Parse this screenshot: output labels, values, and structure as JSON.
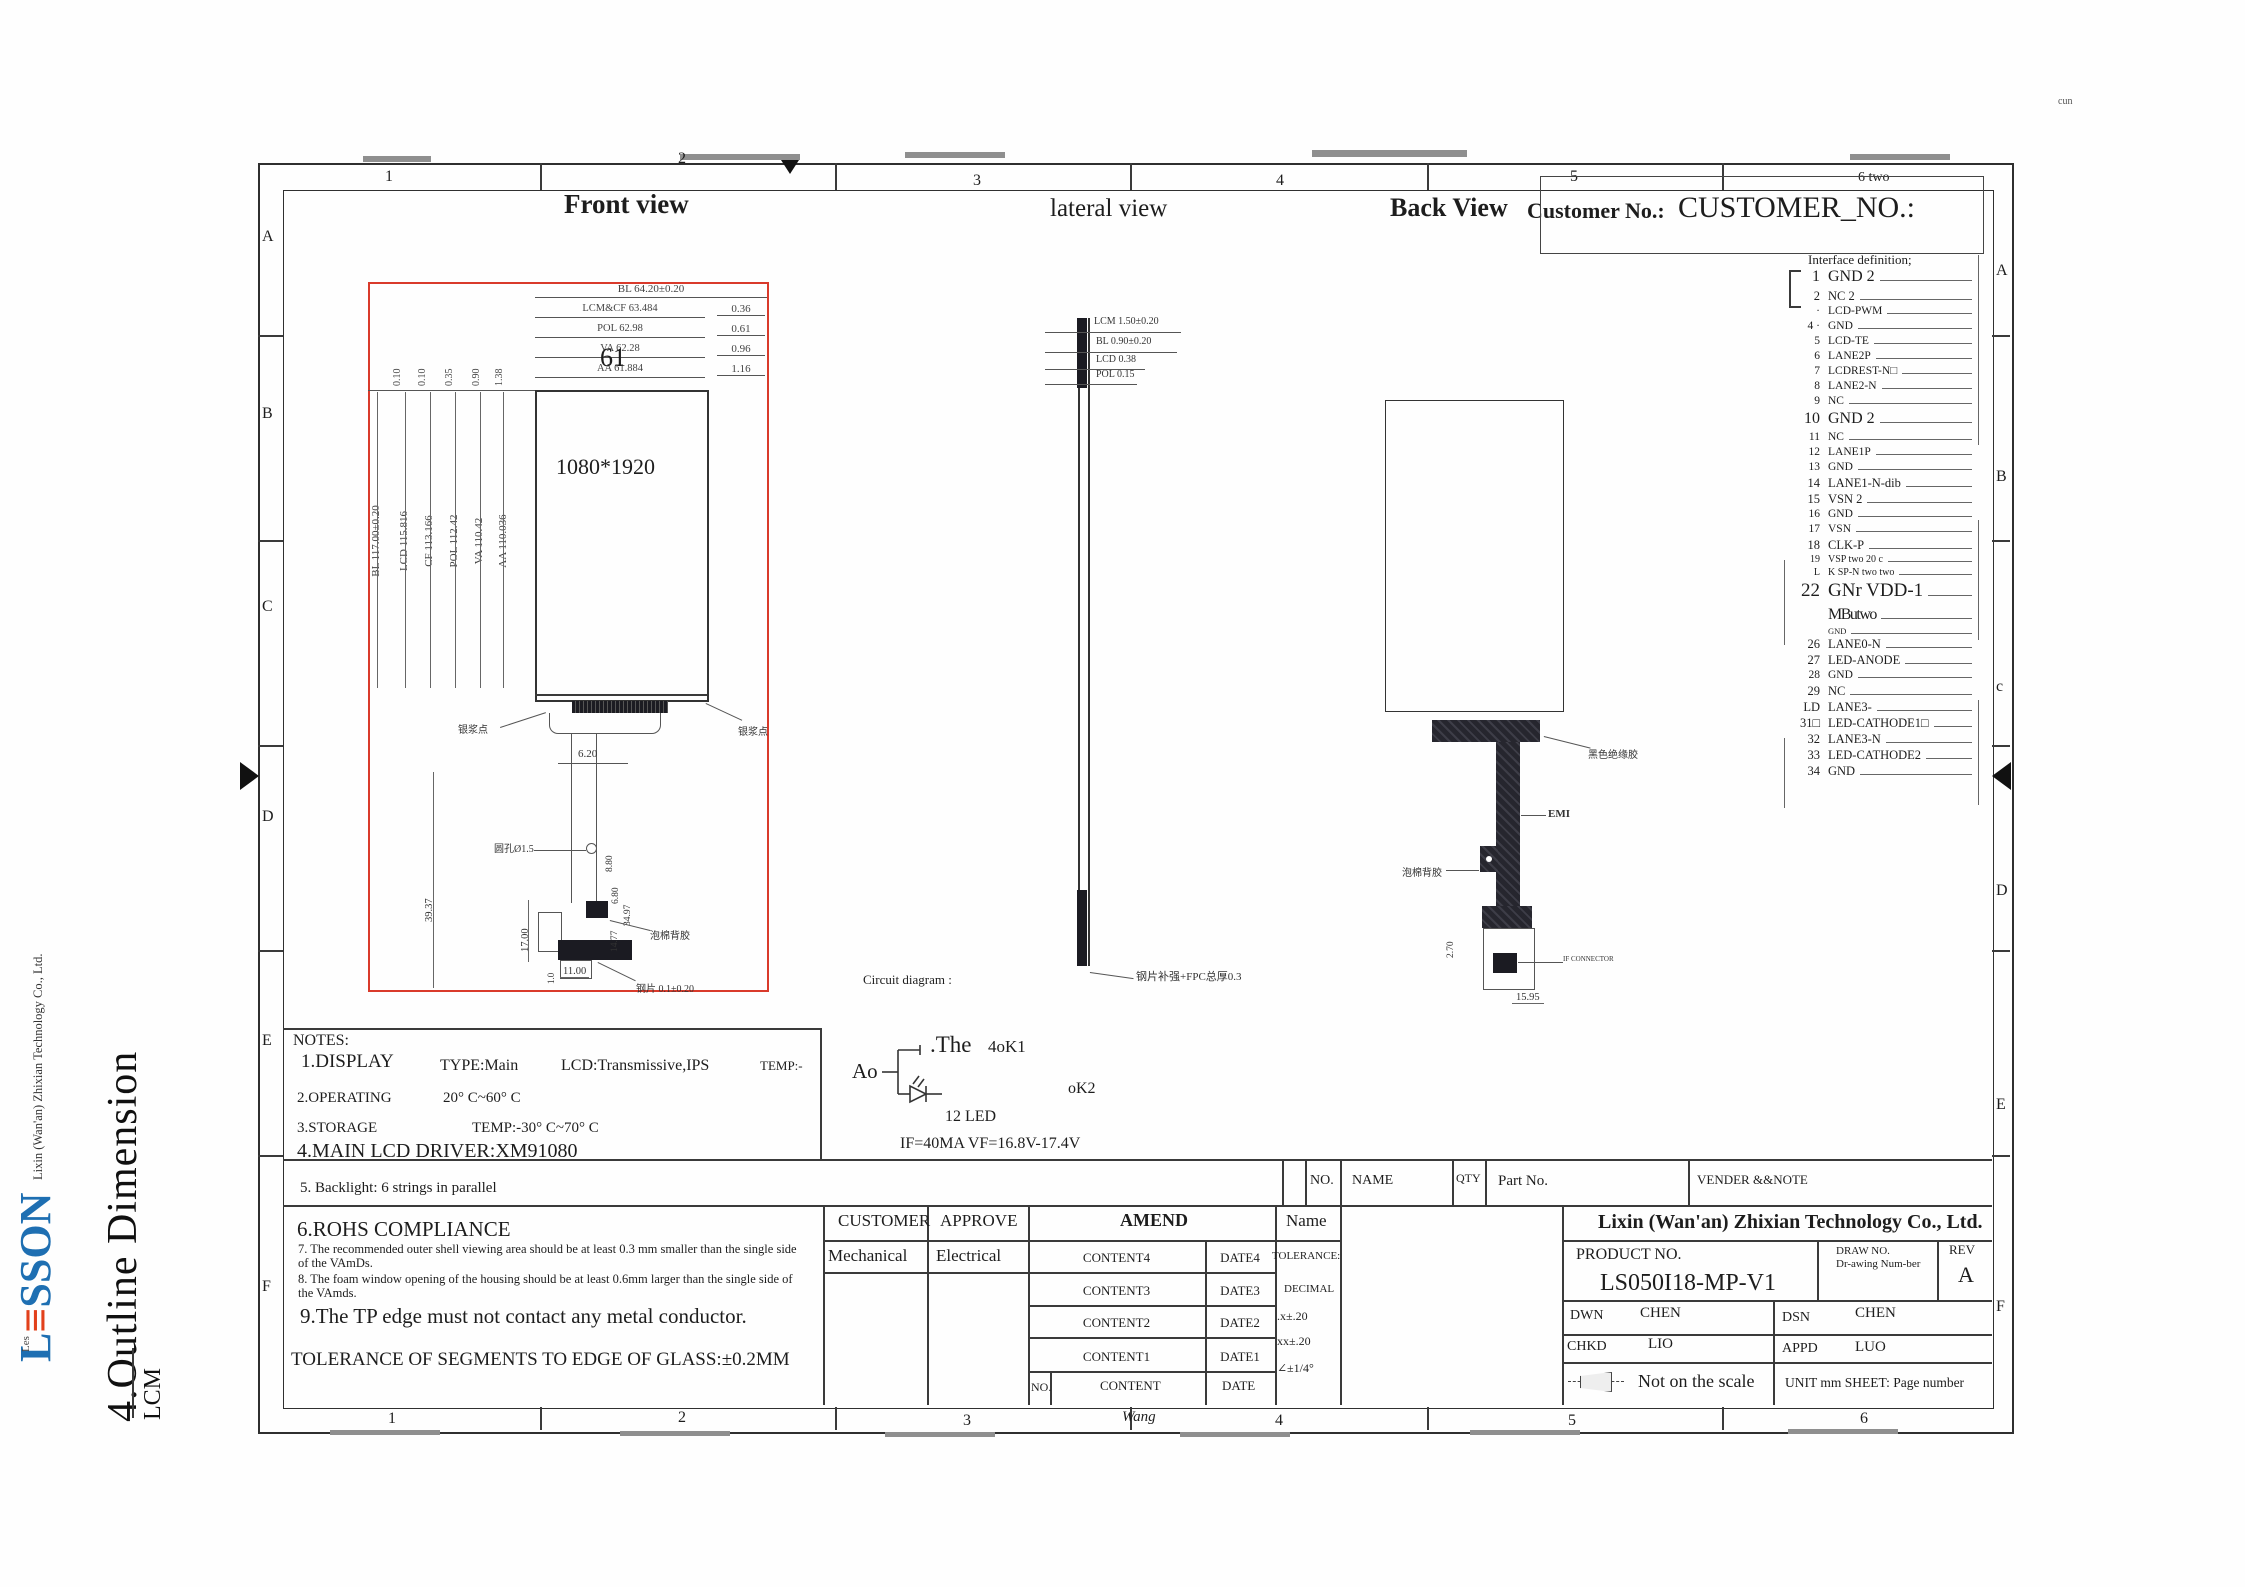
{
  "meta": {
    "corner_note": "cun"
  },
  "colors": {
    "frontview_box": "#d93a2b",
    "logo_blue": "#1e6fb2",
    "logo_red": "#e2401b",
    "line": "#333333"
  },
  "branding": {
    "logo_l": "L",
    "logo_e": "≡",
    "logo_rest": "SSON",
    "logo_sub": "Les",
    "company_side": "Lixin (Wan'an) Zhixian Technology Co., Ltd.",
    "section_title": "4.Outline Dimension",
    "lcm": "LCM"
  },
  "grid": {
    "top": [
      {
        "t": "1"
      },
      {
        "t": "2"
      },
      {
        "t": "3"
      },
      {
        "t": "4"
      },
      {
        "t": "5"
      },
      {
        "t": "6 two"
      }
    ],
    "bottom": [
      {
        "t": "1"
      },
      {
        "t": "2"
      },
      {
        "t": "3"
      },
      {
        "t": "Wang"
      },
      {
        "t": "4"
      },
      {
        "t": "5"
      },
      {
        "t": "6"
      }
    ],
    "left": [
      {
        "t": "A"
      },
      {
        "t": "B"
      },
      {
        "t": "C"
      },
      {
        "t": "D"
      },
      {
        "t": "E"
      },
      {
        "t": "F"
      }
    ],
    "right": [
      {
        "t": "A"
      },
      {
        "t": "B"
      },
      {
        "t": "c"
      },
      {
        "t": "D"
      },
      {
        "t": "E"
      },
      {
        "t": "F"
      }
    ]
  },
  "titles": {
    "front": "Front view",
    "lateral": "lateral view",
    "back": "Back View",
    "customer_label": "Customer No.:",
    "customer_no": "CUSTOMER_NO.:"
  },
  "front_view": {
    "resolution": "1080*1920",
    "big_num": "61",
    "top_dims": [
      {
        "label": "BL 64.20±0.20",
        "right": ""
      },
      {
        "label": "LCM&CF 63.484",
        "right": "0.36"
      },
      {
        "label": "POL 62.98",
        "right": "0.61"
      },
      {
        "label": "VA 62.28",
        "right": "0.96"
      },
      {
        "label": "AA 61.884",
        "right": "1.16"
      }
    ],
    "left_small_dims": [
      {
        "t": "0.10"
      },
      {
        "t": "0.10"
      },
      {
        "t": "0.35"
      },
      {
        "t": "0.90"
      },
      {
        "t": "1.38"
      }
    ],
    "left_dims": [
      {
        "t": "BL 117.00±0.20"
      },
      {
        "t": "LCD 115.816"
      },
      {
        "t": "CF 113.166"
      },
      {
        "t": "POL 112.42"
      },
      {
        "t": "VA 110.42"
      },
      {
        "t": "AA 110.036"
      }
    ],
    "tail": {
      "dim_w": "6.20",
      "dim_h_left": "39.37",
      "dim_17": "17.00",
      "dim_11": "11.00",
      "dim_880": "8.80",
      "dim_680": "6.80",
      "dim_3497": "34.97",
      "dim_1477": "14.77",
      "dim_10": "1.0",
      "ann_silver_left": "银浆点",
      "ann_silver_right": "银浆点",
      "ann_hole": "圆孔Ø1.5",
      "ann_foam": "泡棉背胶",
      "ann_steel": "钢片 0.1±0.20"
    }
  },
  "lateral_view": {
    "dims": [
      {
        "t": "LCM 1.50±0.20"
      },
      {
        "t": "BL 0.90±0.20"
      },
      {
        "t": "LCD 0.38"
      },
      {
        "t": "POL 0.15"
      }
    ],
    "note": "钢片补强+FPC总厚0.3"
  },
  "back_view": {
    "ann_glue": "黑色绝缘胶",
    "ann_emi": "EMI",
    "ann_foam": "泡棉背胶",
    "dim_v": "2.70",
    "dim_h": "15.95",
    "ann_connector": "IF CONNECTOR"
  },
  "interface": {
    "title": "Interface definition;",
    "pins": [
      {
        "num": "1",
        "name": "GND 2",
        "cls": "lg"
      },
      {
        "num": "2",
        "name": "NC 2",
        "cls": "md"
      },
      {
        "num": "·",
        "name": "LCD-PWM"
      },
      {
        "num": "4 ·",
        "name": "GND"
      },
      {
        "num": "5",
        "name": "LCD-TE"
      },
      {
        "num": "6",
        "name": "LANE2P"
      },
      {
        "num": "7",
        "name": "LCDREST-N□"
      },
      {
        "num": "8",
        "name": "LANE2-N"
      },
      {
        "num": "9",
        "name": "NC"
      },
      {
        "num": "10",
        "name": "GND 2",
        "cls": "lg"
      },
      {
        "num": "11",
        "name": "NC"
      },
      {
        "num": "12",
        "name": "LANE1P"
      },
      {
        "num": "13",
        "name": "GND"
      },
      {
        "num": "14",
        "name": "LANE1-N-dib",
        "cls": "md"
      },
      {
        "num": "15",
        "name": "VSN 2",
        "cls": "md"
      },
      {
        "num": "16",
        "name": "GND"
      },
      {
        "num": "17",
        "name": "VSN"
      },
      {
        "num": "18",
        "name": "CLK-P",
        "cls": "md"
      },
      {
        "num": "19",
        "name": "VSP two 20 c",
        "cls": "sm"
      },
      {
        "num": "L",
        "name": "K SP-N two two",
        "cls": "sm"
      },
      {
        "num": "22",
        "name": "GNr VDD-1",
        "cls": "xl"
      },
      {
        "num": "",
        "name": "MButwo",
        "cls": "garble"
      },
      {
        "num": "",
        "name": "GND",
        "cls": "xs"
      },
      {
        "num": "26",
        "name": "LANE0-N",
        "cls": "md"
      },
      {
        "num": "27",
        "name": "LED-ANODE",
        "cls": "md"
      },
      {
        "num": "28",
        "name": "GND"
      },
      {
        "num": "29",
        "name": "NC",
        "cls": "md"
      },
      {
        "num": "LD",
        "name": "LANE3-",
        "cls": "md"
      },
      {
        "num": "31□",
        "name": "LED-CATHODE1□",
        "cls": "md"
      },
      {
        "num": "32",
        "name": "LANE3-N",
        "cls": "md"
      },
      {
        "num": "33",
        "name": "LED-CATHODE2",
        "cls": "md"
      },
      {
        "num": "34",
        "name": "GND",
        "cls": "md"
      }
    ]
  },
  "circuit": {
    "label": "Circuit diagram :",
    "the": ".The",
    "k1": "4oK1",
    "ao": "Ao",
    "k2": "oK2",
    "led_count": "12  LED",
    "spec": "IF=40MA    VF=16.8V-17.4V"
  },
  "notes": {
    "title": "NOTES:",
    "n1": "1.DISPLAY",
    "n1_type": "TYPE:Main",
    "n1_lcd": "LCD:Transmissive,IPS",
    "n1_temp": "TEMP:-",
    "n2": "2.OPERATING",
    "n2_val": "20° C~60° C",
    "n3": "3.STORAGE",
    "n3_val": "TEMP:-30° C~70° C",
    "n4": "4.MAIN LCD DRIVER:XM91080",
    "n5": "5. Backlight: 6 strings in parallel",
    "n6": "6.ROHS COMPLIANCE",
    "n7": "7. The recommended outer shell viewing area should be at least 0.3 mm smaller than the single side of the VAmDs.",
    "n8": "8. The foam window opening of the housing should be at least 0.6mm larger than the single side of the VAmds.",
    "n9": "9.The TP edge must not contact any metal conductor.",
    "tol": "TOLERANCE OF SEGMENTS TO EDGE OF GLASS:±0.2MM"
  },
  "parts_table": {
    "headers": [
      {
        "t": "NO."
      },
      {
        "t": "NAME"
      },
      {
        "t": "QTY"
      },
      {
        "t": "Part  No."
      },
      {
        "t": "VENDER &&NOTE"
      }
    ]
  },
  "title_block": {
    "customer": "CUSTOMER",
    "approve": "APPROVE",
    "mechanical": "Mechanical",
    "electrical": "Electrical",
    "amend": "AMEND",
    "name_col": "Name",
    "amend_rows": [
      {
        "c": "CONTENT4",
        "d": "DATE4"
      },
      {
        "c": "CONTENT3",
        "d": "DATE3"
      },
      {
        "c": "CONTENT2",
        "d": "DATE2"
      },
      {
        "c": "CONTENT1",
        "d": "DATE1"
      }
    ],
    "no_label": "NO.",
    "content_label": "CONTENT",
    "date_label": "DATE",
    "tolerance_title": "TOLERANCE:",
    "tol_decimal": "DECIMAL",
    "tol_x": ".x±.20",
    "tol_xx": "xx±.20",
    "tol_angle": "∠±1/4°",
    "company": "Lixin (Wan'an) Zhixian Technology Co., Ltd.",
    "product_label": "PRODUCT  NO.",
    "product_no": "LS050I18-MP-V1",
    "draw_label": "DRAW  NO.",
    "draw_value": "Dr-awing Num-ber",
    "rev_label": "REV",
    "rev": "A",
    "dwn_label": "DWN",
    "dwn": "CHEN",
    "dsn_label": "DSN",
    "dsn": "CHEN",
    "chkd_label": "CHKD",
    "chkd": "LIO",
    "appd_label": "APPD",
    "appd": "LUO",
    "scale_note": "Not on the scale",
    "unit_note": "UNIT mm SHEET: Page number"
  }
}
